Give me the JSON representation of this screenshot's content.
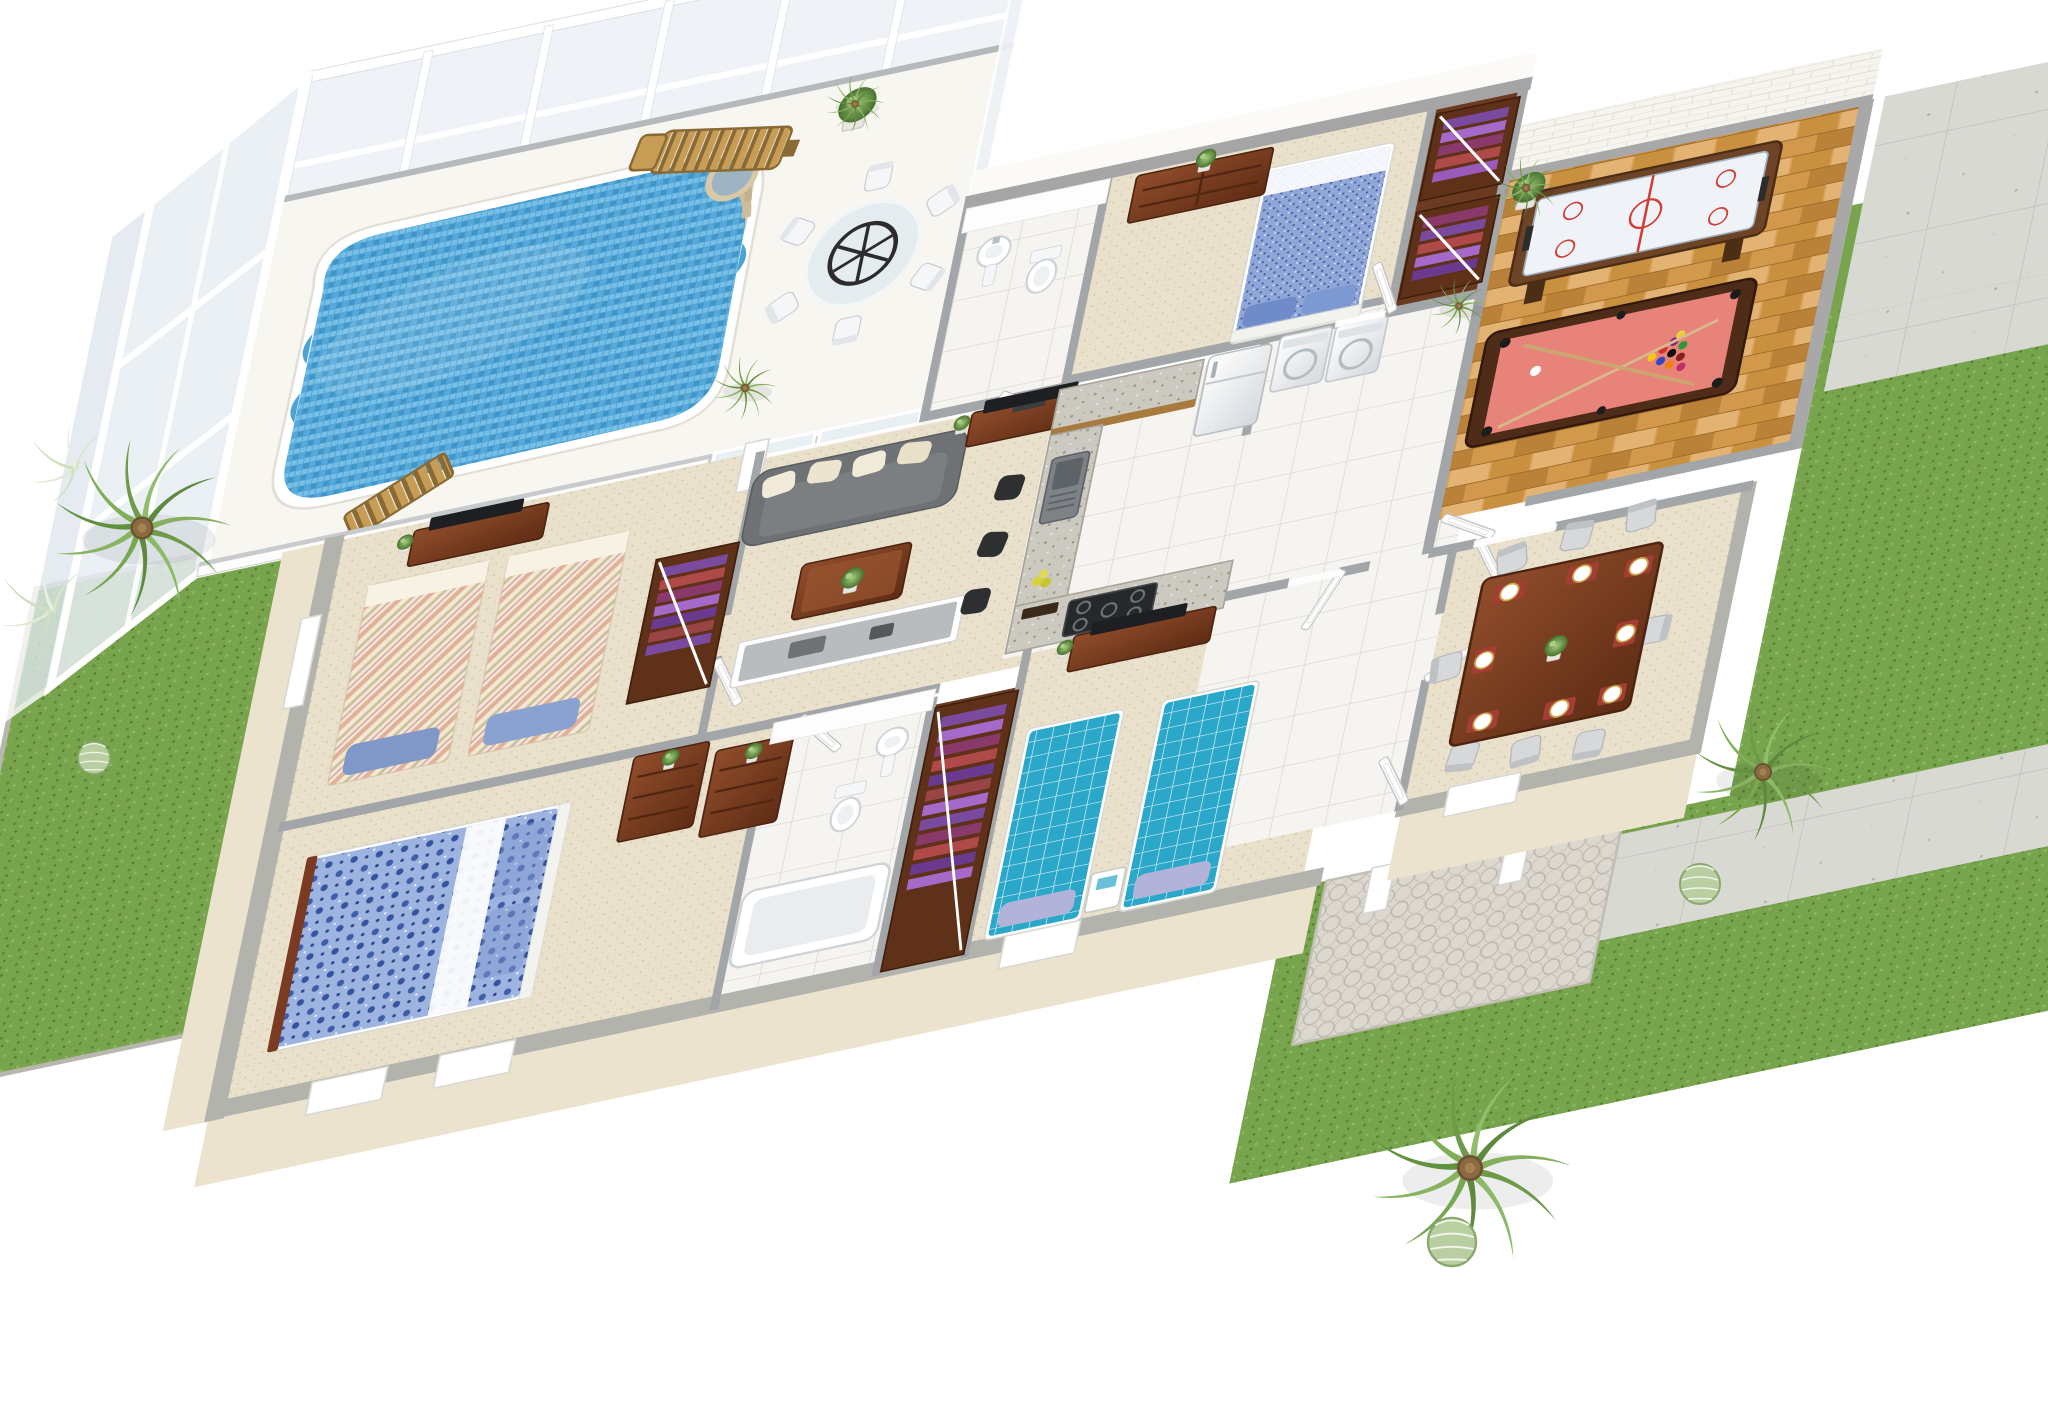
{
  "scene": {
    "title": "3D isometric floor plan rendering of a single-storey villa",
    "view": "cutaway birds-eye render",
    "background": "#ffffff"
  },
  "colors": {
    "pool": "#4fa3d4",
    "pool_tile_light": "#8fd0f0",
    "deck": "#f8f6f1",
    "glass": "#eef2f6",
    "grass": "#79a44e",
    "carpet": "#eae1cd",
    "tile": "#f6f4f0",
    "wood_floor": "#d9a15c",
    "closet_wood": "#6b3a20",
    "exterior_wall": "#ece3cf",
    "wall_cap": "#a2a6a9",
    "mahogany": "#7e4124",
    "sofa": "#6e7275",
    "pool_table_felt": "#e8837a",
    "air_hockey_frame": "#6e4427",
    "teal_bed": "#2aa7c9",
    "floral_bed": "#9db3e0",
    "speckle_bed": "#8fa6d6",
    "stripe_bed": "#f3e9d2",
    "pillow_blue": "#7f98c8",
    "concrete": "#d9d9d4",
    "paver": "#dcd8d0",
    "door": "#ffffff",
    "palm_green": "#6f9a4a"
  },
  "lanai": {
    "name": "screened pool lanai",
    "items": [
      {
        "name": "swimming-pool"
      },
      {
        "name": "pool-steps-spa"
      },
      {
        "name": "lounge-chair"
      },
      {
        "name": "patio-table"
      },
      {
        "name": "patio-chair",
        "count": 6
      },
      {
        "name": "potted-plant"
      },
      {
        "name": "small-palm"
      },
      {
        "name": "wood-bench"
      }
    ]
  },
  "rooms": [
    {
      "name": "living-room",
      "floor": "carpet",
      "items": [
        "sofa",
        "throw-pillow x4",
        "coffee-table",
        "tv-console",
        "tv",
        "side-desk",
        "dresser",
        "bar-stool x3"
      ]
    },
    {
      "name": "kitchen",
      "floor": "tile",
      "items": [
        "granite-counter",
        "sink",
        "gas-cooktop",
        "wood-cabinets",
        "refrigerator",
        "fruit-bowl"
      ]
    },
    {
      "name": "laundry-nook",
      "floor": "tile",
      "items": [
        "washer",
        "dryer"
      ]
    },
    {
      "name": "bedroom-blue",
      "floor": "carpet",
      "items": [
        "double-bed-blue-speckle",
        "dresser",
        "plant",
        "walk-in-closet x2"
      ]
    },
    {
      "name": "bathroom-top",
      "floor": "tile",
      "items": [
        "pedestal-sink",
        "toilet"
      ]
    },
    {
      "name": "game-room",
      "floor": "parquet",
      "items": [
        "air-hockey-table",
        "billiard-table",
        "billiard-balls",
        "cue x2",
        "potted-tree"
      ]
    },
    {
      "name": "dining-room",
      "floor": "carpet",
      "items": [
        "dining-table",
        "dining-chair x8",
        "place-setting x8",
        "centerpiece-plant"
      ]
    },
    {
      "name": "bedroom-striped",
      "floor": "carpet",
      "items": [
        "twin-bed-striped x2",
        "tv-console",
        "tv",
        "closet",
        "window"
      ]
    },
    {
      "name": "master-bedroom",
      "floor": "carpet",
      "items": [
        "double-bed-floral",
        "dresser",
        "plant"
      ]
    },
    {
      "name": "bathroom-master",
      "floor": "tile",
      "items": [
        "bathtub",
        "toilet",
        "pedestal-sink"
      ]
    },
    {
      "name": "walk-in-closet",
      "floor": "wood",
      "items": [
        "clothes-rail",
        "hanging-clothes"
      ]
    },
    {
      "name": "bedroom-teal",
      "floor": "carpet",
      "items": [
        "twin-bed-teal x2",
        "nightstand",
        "tv-console",
        "tv",
        "plant"
      ]
    }
  ],
  "outdoor": {
    "left_yard": [
      "palm-tree",
      "ferns",
      "cactus-ball"
    ],
    "right_yard": [
      "palm-tree x2",
      "cactus-ball x2",
      "stone-apron",
      "concrete-path x2",
      "paver-patio",
      "white-posts"
    ]
  }
}
